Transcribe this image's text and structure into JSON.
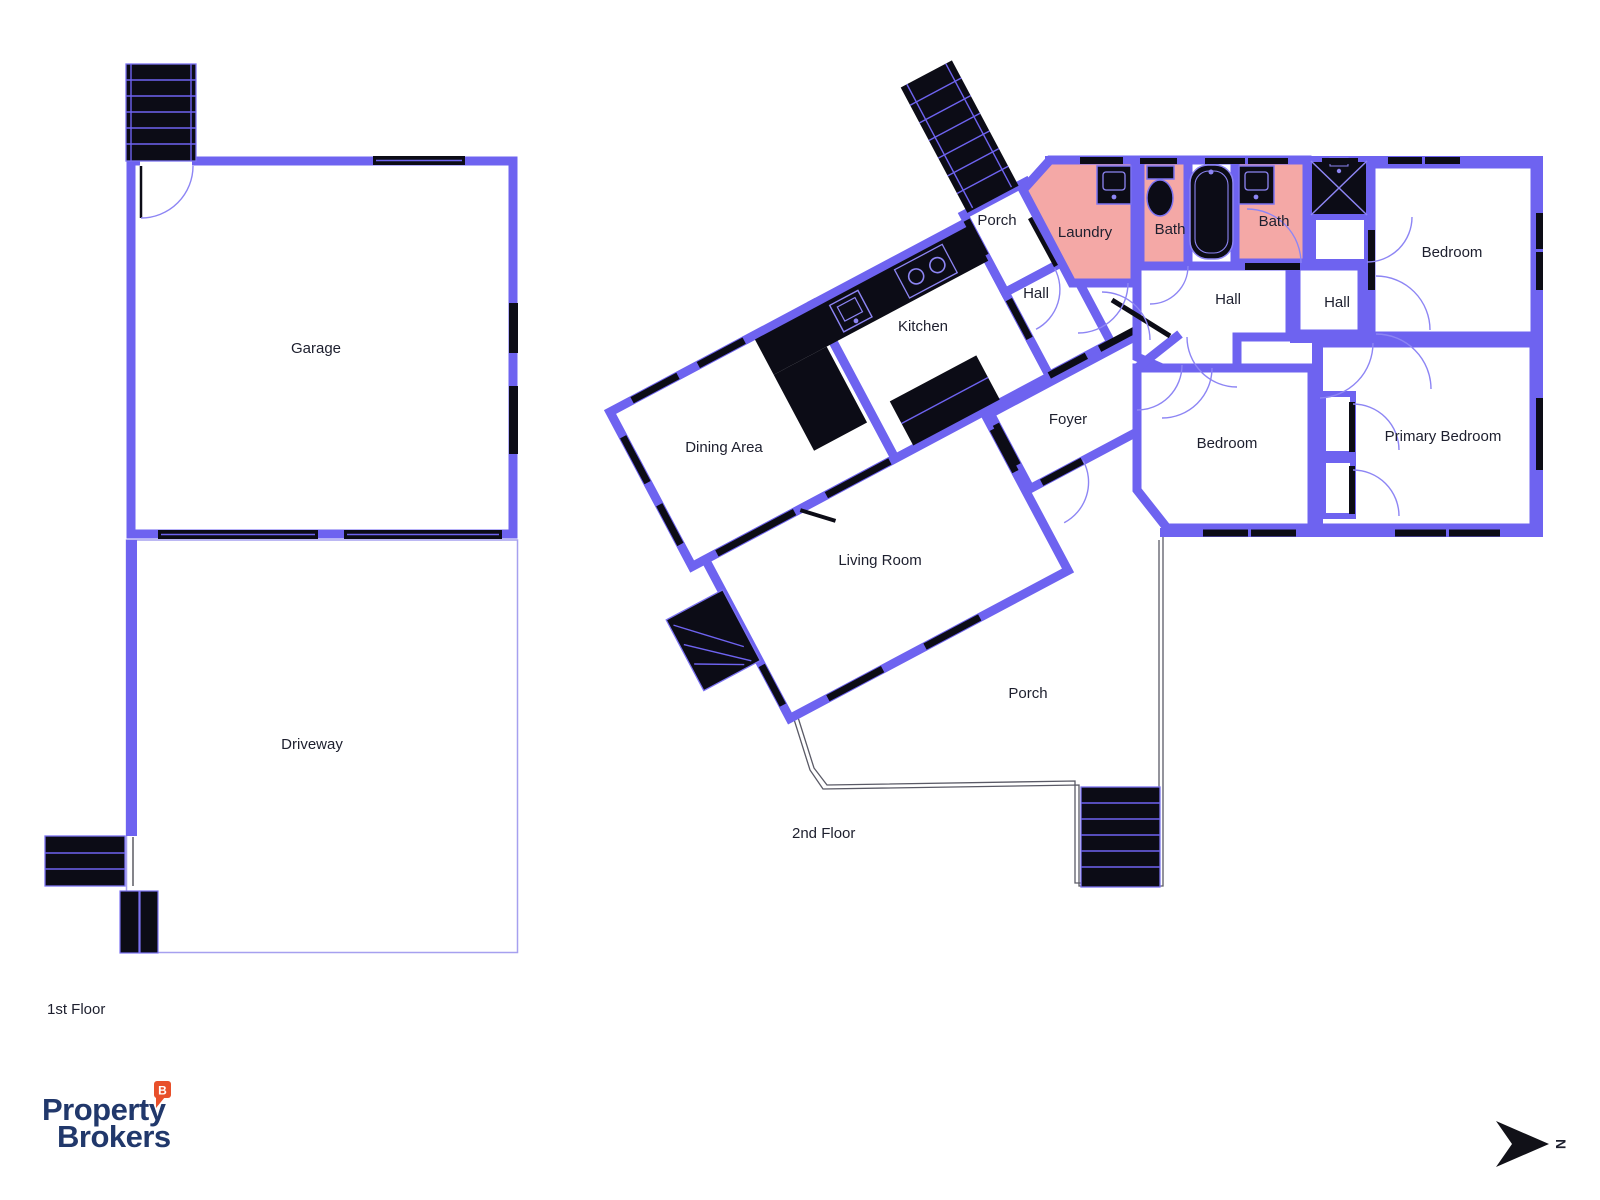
{
  "floors": {
    "first": "1st Floor",
    "second": "2nd Floor"
  },
  "first_floor_rooms": {
    "garage": "Garage",
    "driveway": "Driveway"
  },
  "second_floor_rooms": {
    "porch_top": "Porch",
    "laundry": "Laundry",
    "bath_left": "Bath",
    "bath_right": "Bath",
    "bedroom_top_right": "Bedroom",
    "hall_wing": "Hall",
    "hall_main": "Hall",
    "hall_small": "Hall",
    "kitchen": "Kitchen",
    "dining_area": "Dining Area",
    "foyer": "Foyer",
    "living_room": "Living Room",
    "bedroom_middle": "Bedroom",
    "primary_bedroom": "Primary Bedroom",
    "porch_bottom": "Porch"
  },
  "branding": {
    "line1": "Property",
    "line2": "Brokers",
    "badge": "B"
  },
  "compass": {
    "north": "N"
  },
  "colors": {
    "wall": "#6e63f0",
    "bath_fill": "#f4a8a6",
    "fixture": "#0c0c16",
    "door_arc": "#8d85f4",
    "porch_outline": "#5a5a66",
    "logo_navy": "#21386b",
    "logo_orange": "#e8502b",
    "label_text": "#1d1f2e"
  }
}
